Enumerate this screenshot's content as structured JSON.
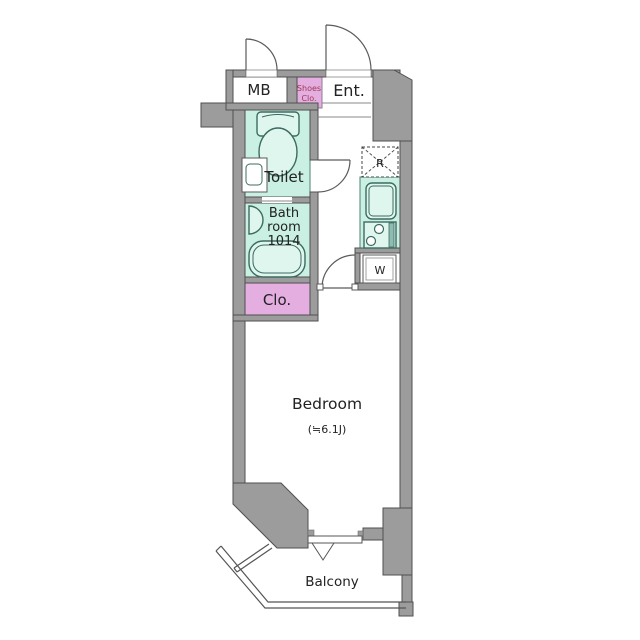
{
  "plan": {
    "type": "apartment-floor-plan",
    "rooms": {
      "mb_label": "MB",
      "shoes_closet_line1": "Shoes",
      "shoes_closet_line2": "Clo.",
      "entrance_label": "Ent.",
      "toilet_label": "Toilet",
      "bath_line1": "Bath",
      "bath_line2": "room",
      "bath_line3": "1014",
      "closet_label": "Clo.",
      "bedroom_label": "Bedroom",
      "bedroom_size": "(≒6.1J)",
      "balcony_label": "Balcony",
      "washer_label": "W",
      "refrigerator_label": "R"
    },
    "colors": {
      "wall_gray": "#9c9c9c",
      "wall_outline": "#4f4f4f",
      "wet_area_green": "#c9f0e3",
      "fixture_green": "#def6ee",
      "closet_pink": "#e4aee0",
      "shoes_text": "#9c3a55",
      "label_text": "#222222",
      "background": "#ffffff"
    }
  }
}
